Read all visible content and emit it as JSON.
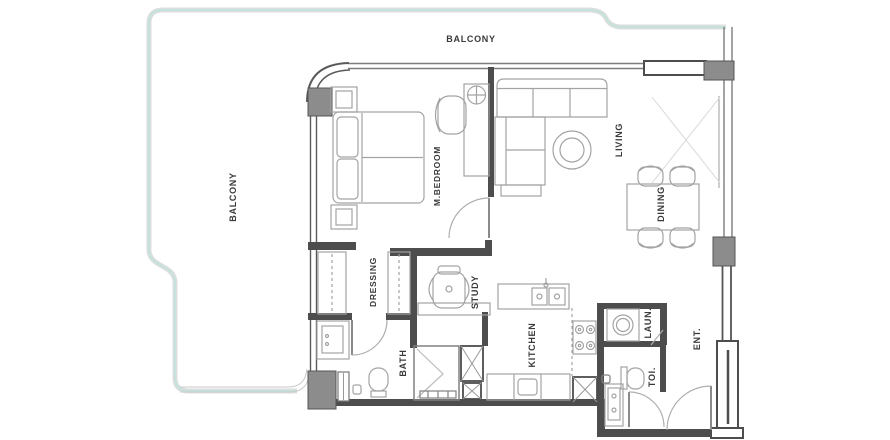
{
  "plan_type": "apartment-floor-plan",
  "rooms": {
    "balcony_top": {
      "label": "BALCONY"
    },
    "balcony_left": {
      "label": "BALCONY"
    },
    "master_bedroom": {
      "label": "M.BEDROOM"
    },
    "living": {
      "label": "LIVING"
    },
    "dining": {
      "label": "DINING"
    },
    "dressing": {
      "label": "DRESSING"
    },
    "study": {
      "label": "STUDY"
    },
    "bath": {
      "label": "BATH"
    },
    "kitchen": {
      "label": "KITCHEN"
    },
    "laundry": {
      "label": "LAUN."
    },
    "toilet": {
      "label": "TOI."
    },
    "entrance": {
      "label": "ENT."
    }
  },
  "colors": {
    "background": "#ffffff",
    "wall": "#4d4d4d",
    "column_fill": "#8c8c8c",
    "window_line": "#7d7d7d",
    "furniture_line": "#a3a3a3",
    "balcony_line_teal": "#c4e2db",
    "balcony_line_gray": "#dedede",
    "label_text": "#3a3a3a"
  },
  "fixtures": [
    "double-bed",
    "nightstand",
    "nightstand",
    "dressing-table-with-mirror",
    "bedroom-chair",
    "l-shaped-sofa",
    "round-coffee-table",
    "dining-table",
    "dining-chair-x4",
    "wardrobe",
    "wardrobe",
    "study-desk",
    "desk-chair",
    "bath-vanity",
    "toilet-wc",
    "shower-enclosure",
    "kitchen-island-sink",
    "cooktop-4-burner",
    "base-cabinets",
    "duct-shaft",
    "washing-machine",
    "toilet-wc-guest",
    "guest-vanity",
    "swing-door-bedroom",
    "swing-door-bath",
    "swing-door-toilet",
    "entrance-door"
  ]
}
